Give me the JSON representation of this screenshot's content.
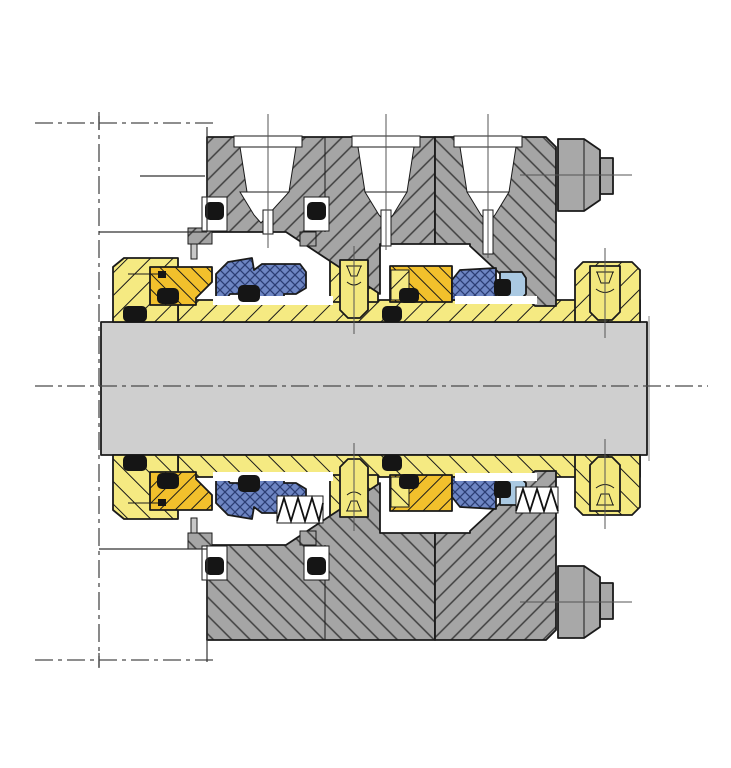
{
  "diagram": {
    "title": "Cartridge mechanical seal assembly — shaft cross-section",
    "type": "technical-cross-section",
    "view": "side section through horizontal shaft centerline, mirrored about axis",
    "colors": {
      "background": "#ffffff",
      "outline": "#1a1a1a",
      "construction": "#4a4a4a",
      "shaft": "#cfcfcf",
      "shaft_edge": "#7a7a7a",
      "housing": "#a5a5a5",
      "housing_hatch": "#3f3f3f",
      "fastener": "#a8a8a8",
      "sleeve": "#f5ea82",
      "screw": "#f3e87e",
      "face_ring": "#f2c02c",
      "elastomer": "#6e86c3",
      "elastomer_hatch": "#2b3d73",
      "seat": "#aac9e2",
      "oring": "#151515",
      "pin": "#c8c8c8",
      "white": "#ffffff"
    },
    "counts": {
      "flush_ports_top": 3,
      "springs_bottom": 2,
      "set_screws_per_half": 2,
      "gland_nuts": 2,
      "orings_per_half": 8
    },
    "parts": [
      {
        "id": "shaft",
        "label": "pump shaft",
        "material_color": "#cfcfcf"
      },
      {
        "id": "sleeve",
        "label": "shaft sleeve with flange and band",
        "material_color": "#f5ea82"
      },
      {
        "id": "drive-collar",
        "label": "drive collar with socket set screw",
        "material_color": "#f5ea82"
      },
      {
        "id": "mid-collar",
        "label": "center collar with socket set screw",
        "material_color": "#f5ea82"
      },
      {
        "id": "gland-inboard",
        "label": "gland plate segment (inboard)",
        "material_color": "#a5a5a5"
      },
      {
        "id": "gland-outboard",
        "label": "gland plate segment (outboard)",
        "material_color": "#a5a5a5"
      },
      {
        "id": "face-ring-1",
        "label": "stage-1 seal face ring",
        "material_color": "#f2c02c"
      },
      {
        "id": "face-ring-2",
        "label": "stage-2 seal face ring",
        "material_color": "#f2c02c"
      },
      {
        "id": "bellows-1",
        "label": "stage-1 elastomer bellows",
        "material_color": "#6e86c3"
      },
      {
        "id": "bellows-2",
        "label": "stage-2 elastomer bellows",
        "material_color": "#6e86c3"
      },
      {
        "id": "seat",
        "label": "stationary seat insert",
        "material_color": "#aac9e2"
      },
      {
        "id": "orings",
        "label": "O-rings and gaskets",
        "material_color": "#151515"
      },
      {
        "id": "springs",
        "label": "compression springs (shown below axis)",
        "material_color": "#111111"
      },
      {
        "id": "gland-nut",
        "label": "hex nut on gland stud",
        "material_color": "#a8a8a8"
      },
      {
        "id": "flush-ports",
        "label": "tapped flush ports (above axis)",
        "material_color": "#ffffff"
      },
      {
        "id": "stuffing-box",
        "label": "stuffing box face outline",
        "material_color": "#ffffff"
      }
    ],
    "linework": {
      "centerline_style": "dash-dot",
      "shaft_axis_y": 386,
      "reference_line_x": 99,
      "hatch": "45-degree section hatching, direction alternates between adjacent parts"
    }
  }
}
